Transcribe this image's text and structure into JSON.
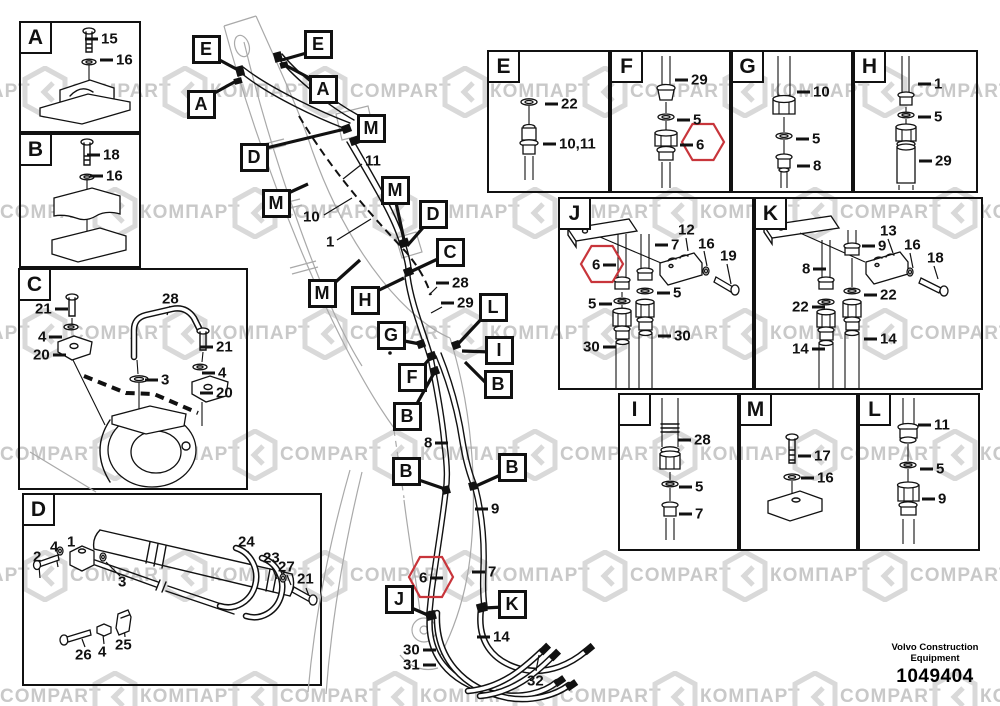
{
  "brand": {
    "line1": "Volvo Construction",
    "line2": "Equipment",
    "part_number": "1049404"
  },
  "watermark": {
    "latin": "COMPART",
    "cyrillic": "КОМПАРТ"
  },
  "colors": {
    "highlight": "#c8353b",
    "watermark_text": "#c9c9c9",
    "watermark_logo": "#d9d9d9"
  },
  "panels": [
    {
      "letter": "A",
      "x": 19,
      "y": 21,
      "w": 122,
      "h": 112,
      "labels": [
        {
          "t": "15",
          "x": 85,
          "y": 39,
          "d": "l"
        },
        {
          "t": "16",
          "x": 100,
          "y": 60,
          "d": "l"
        }
      ]
    },
    {
      "letter": "B",
      "x": 19,
      "y": 133,
      "w": 122,
      "h": 135,
      "labels": [
        {
          "t": "18",
          "x": 87,
          "y": 155,
          "d": "l"
        },
        {
          "t": "16",
          "x": 90,
          "y": 176,
          "d": "l"
        }
      ]
    },
    {
      "letter": "C",
      "x": 18,
      "y": 268,
      "w": 230,
      "h": 222,
      "labels": [
        {
          "t": "21",
          "x": 35,
          "y": 309,
          "d": "r"
        },
        {
          "t": "4",
          "x": 38,
          "y": 337,
          "d": "r"
        },
        {
          "t": "20",
          "x": 33,
          "y": 355,
          "d": "r"
        },
        {
          "t": "28",
          "x": 162,
          "y": 299,
          "d": null
        },
        {
          "t": "3",
          "x": 145,
          "y": 380,
          "d": "l"
        },
        {
          "t": "21",
          "x": 200,
          "y": 347,
          "d": "l"
        },
        {
          "t": "4",
          "x": 202,
          "y": 373,
          "d": "l"
        },
        {
          "t": "20",
          "x": 200,
          "y": 393,
          "d": "l"
        }
      ]
    },
    {
      "letter": "D",
      "x": 22,
      "y": 493,
      "w": 300,
      "h": 193,
      "labels": [
        {
          "t": "2",
          "x": 33,
          "y": 557,
          "d": null
        },
        {
          "t": "4",
          "x": 50,
          "y": 547,
          "d": null
        },
        {
          "t": "1",
          "x": 67,
          "y": 542,
          "d": null
        },
        {
          "t": "3",
          "x": 118,
          "y": 582,
          "d": null
        },
        {
          "t": "24",
          "x": 238,
          "y": 542,
          "d": null
        },
        {
          "t": "23",
          "x": 263,
          "y": 558,
          "d": null
        },
        {
          "t": "27",
          "x": 278,
          "y": 567,
          "d": null
        },
        {
          "t": "21",
          "x": 297,
          "y": 579,
          "d": null
        },
        {
          "t": "26",
          "x": 75,
          "y": 655,
          "d": null
        },
        {
          "t": "4",
          "x": 98,
          "y": 652,
          "d": null
        },
        {
          "t": "25",
          "x": 115,
          "y": 645,
          "d": null
        }
      ]
    },
    {
      "letter": "E",
      "x": 487,
      "y": 50,
      "w": 123,
      "h": 143,
      "labels": [
        {
          "t": "22",
          "x": 545,
          "y": 104,
          "d": "l"
        },
        {
          "t": "10,11",
          "x": 543,
          "y": 144,
          "d": "l"
        }
      ]
    },
    {
      "letter": "F",
      "x": 610,
      "y": 50,
      "w": 121,
      "h": 143,
      "labels": [
        {
          "t": "29",
          "x": 675,
          "y": 80,
          "d": "l"
        },
        {
          "t": "5",
          "x": 677,
          "y": 120,
          "d": "l"
        },
        {
          "t": "6",
          "x": 680,
          "y": 145,
          "d": "l"
        }
      ]
    },
    {
      "letter": "G",
      "x": 731,
      "y": 50,
      "w": 122,
      "h": 143,
      "labels": [
        {
          "t": "10",
          "x": 797,
          "y": 92,
          "d": "l"
        },
        {
          "t": "5",
          "x": 796,
          "y": 139,
          "d": "l"
        },
        {
          "t": "8",
          "x": 797,
          "y": 166,
          "d": "l"
        }
      ]
    },
    {
      "letter": "H",
      "x": 853,
      "y": 50,
      "w": 125,
      "h": 143,
      "labels": [
        {
          "t": "1",
          "x": 918,
          "y": 84,
          "d": "l"
        },
        {
          "t": "5",
          "x": 918,
          "y": 117,
          "d": "l"
        },
        {
          "t": "29",
          "x": 919,
          "y": 161,
          "d": "l"
        }
      ]
    },
    {
      "letter": "J",
      "x": 558,
      "y": 197,
      "w": 196,
      "h": 193,
      "labels": [
        {
          "t": "12",
          "x": 678,
          "y": 230,
          "d": null
        },
        {
          "t": "7",
          "x": 655,
          "y": 245,
          "d": "l"
        },
        {
          "t": "16",
          "x": 698,
          "y": 244,
          "d": null
        },
        {
          "t": "19",
          "x": 720,
          "y": 256,
          "d": null
        },
        {
          "t": "6",
          "x": 592,
          "y": 265,
          "d": "r"
        },
        {
          "t": "5",
          "x": 588,
          "y": 304,
          "d": "r"
        },
        {
          "t": "5",
          "x": 657,
          "y": 293,
          "d": "l"
        },
        {
          "t": "30",
          "x": 583,
          "y": 347,
          "d": "r"
        },
        {
          "t": "30",
          "x": 658,
          "y": 336,
          "d": "l"
        }
      ]
    },
    {
      "letter": "K",
      "x": 754,
      "y": 197,
      "w": 229,
      "h": 193,
      "labels": [
        {
          "t": "13",
          "x": 880,
          "y": 231,
          "d": null
        },
        {
          "t": "9",
          "x": 862,
          "y": 246,
          "d": "l"
        },
        {
          "t": "16",
          "x": 904,
          "y": 245,
          "d": null
        },
        {
          "t": "18",
          "x": 927,
          "y": 258,
          "d": null
        },
        {
          "t": "8",
          "x": 802,
          "y": 269,
          "d": "r"
        },
        {
          "t": "22",
          "x": 792,
          "y": 307,
          "d": "r"
        },
        {
          "t": "22",
          "x": 864,
          "y": 295,
          "d": "l"
        },
        {
          "t": "14",
          "x": 792,
          "y": 349,
          "d": "r"
        },
        {
          "t": "14",
          "x": 864,
          "y": 339,
          "d": "l"
        }
      ]
    },
    {
      "letter": "I",
      "x": 618,
      "y": 393,
      "w": 121,
      "h": 158,
      "labels": [
        {
          "t": "28",
          "x": 678,
          "y": 440,
          "d": "l"
        },
        {
          "t": "5",
          "x": 679,
          "y": 487,
          "d": "l"
        },
        {
          "t": "7",
          "x": 679,
          "y": 514,
          "d": "l"
        }
      ]
    },
    {
      "letter": "M",
      "x": 739,
      "y": 393,
      "w": 119,
      "h": 158,
      "labels": [
        {
          "t": "17",
          "x": 798,
          "y": 456,
          "d": "l"
        },
        {
          "t": "16",
          "x": 801,
          "y": 478,
          "d": "l"
        }
      ]
    },
    {
      "letter": "L",
      "x": 858,
      "y": 393,
      "w": 122,
      "h": 158,
      "labels": [
        {
          "t": "11",
          "x": 918,
          "y": 425,
          "d": "l"
        },
        {
          "t": "5",
          "x": 920,
          "y": 469,
          "d": "l"
        },
        {
          "t": "9",
          "x": 922,
          "y": 499,
          "d": "l"
        }
      ]
    }
  ],
  "callouts": [
    {
      "letter": "E",
      "x": 206,
      "y": 49
    },
    {
      "letter": "E",
      "x": 318,
      "y": 44
    },
    {
      "letter": "A",
      "x": 201,
      "y": 104
    },
    {
      "letter": "A",
      "x": 323,
      "y": 89
    },
    {
      "letter": "D",
      "x": 254,
      "y": 157
    },
    {
      "letter": "M",
      "x": 371,
      "y": 128
    },
    {
      "letter": "M",
      "x": 276,
      "y": 203
    },
    {
      "letter": "M",
      "x": 395,
      "y": 190
    },
    {
      "letter": "D",
      "x": 433,
      "y": 214
    },
    {
      "letter": "C",
      "x": 450,
      "y": 252
    },
    {
      "letter": "M",
      "x": 322,
      "y": 293
    },
    {
      "letter": "H",
      "x": 365,
      "y": 300
    },
    {
      "letter": "G",
      "x": 391,
      "y": 335
    },
    {
      "letter": "L",
      "x": 493,
      "y": 307
    },
    {
      "letter": "I",
      "x": 499,
      "y": 350
    },
    {
      "letter": "F",
      "x": 412,
      "y": 377
    },
    {
      "letter": "B",
      "x": 498,
      "y": 384
    },
    {
      "letter": "B",
      "x": 407,
      "y": 416
    },
    {
      "letter": "B",
      "x": 406,
      "y": 471
    },
    {
      "letter": "B",
      "x": 512,
      "y": 467
    },
    {
      "letter": "J",
      "x": 399,
      "y": 599
    },
    {
      "letter": "K",
      "x": 512,
      "y": 604
    }
  ],
  "main_labels": [
    {
      "t": "11",
      "x": 365,
      "y": 161,
      "d": null
    },
    {
      "t": "10",
      "x": 303,
      "y": 217,
      "d": null
    },
    {
      "t": "1",
      "x": 326,
      "y": 242,
      "d": null
    },
    {
      "t": "28",
      "x": 436,
      "y": 283,
      "d": "l"
    },
    {
      "t": "29",
      "x": 441,
      "y": 303,
      "d": "l"
    },
    {
      "t": "8",
      "x": 424,
      "y": 443,
      "d": "r"
    },
    {
      "t": "9",
      "x": 475,
      "y": 509,
      "d": "l"
    },
    {
      "t": "7",
      "x": 472,
      "y": 572,
      "d": "l"
    },
    {
      "t": "6",
      "x": 419,
      "y": 578,
      "d": "r"
    },
    {
      "t": "14",
      "x": 477,
      "y": 637,
      "d": "l"
    },
    {
      "t": "30",
      "x": 403,
      "y": 650,
      "d": "r"
    },
    {
      "t": "31",
      "x": 403,
      "y": 665,
      "d": "r"
    },
    {
      "t": "32",
      "x": 527,
      "y": 681,
      "d": null
    }
  ]
}
